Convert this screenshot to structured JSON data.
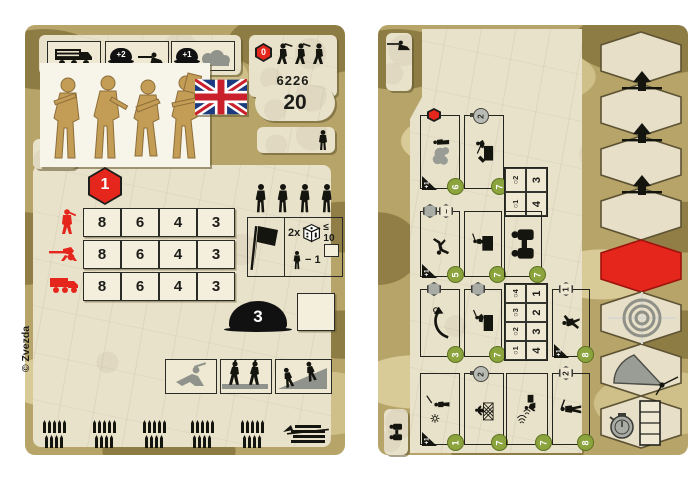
{
  "colors": {
    "accent_red": "#e5261d",
    "badge_green": "#8ba43e",
    "camo_base": "#b6a468",
    "camo_dark": "#8e7c45",
    "camo_light": "#d9cb97",
    "parchment": "#e9e2cb"
  },
  "left_card": {
    "catalog_number": "6226",
    "points": "20",
    "march_hex_value": "0",
    "alert_hex_value": "1",
    "transport_bonus": {
      "trench": "+2",
      "cover": "+1"
    },
    "stats": {
      "rows": [
        {
          "icon": "infantry",
          "values": [
            "8",
            "6",
            "4",
            "3"
          ]
        },
        {
          "icon": "machine-gun",
          "values": [
            "8",
            "6",
            "4",
            "3"
          ]
        },
        {
          "icon": "truck",
          "values": [
            "8",
            "6",
            "4",
            "3"
          ]
        }
      ]
    },
    "morale": {
      "dice_label": "2x",
      "threshold": "≤ 10",
      "penalty": "− 1"
    },
    "helmet_value": "3",
    "copyright": "© Zvezda"
  },
  "right_card": {
    "range_tables": [
      {
        "ranges": [
          "○1",
          "○2"
        ],
        "values": [
          "4",
          "3"
        ]
      },
      {
        "ranges": [
          "○1",
          "○2",
          "○3",
          "○4"
        ],
        "values": [
          "4",
          "3",
          "2",
          "1"
        ]
      }
    ],
    "rows": [
      {
        "boxes": [
          {
            "name": "smoke-screen",
            "marker": "red-hex",
            "badge": "6",
            "bonus": "+1"
          },
          {
            "name": "entrench-crate",
            "marker": "timer",
            "marker_value": "2",
            "badge": "7"
          }
        ]
      },
      {
        "boxes": [
          {
            "name": "casualty",
            "marker": "gray-hex-minus",
            "marker_value": "−",
            "badge": "5",
            "bonus": "+1"
          },
          {
            "name": "mount-crate",
            "badge": "7"
          },
          {
            "name": "observe",
            "badge": "7"
          }
        ]
      },
      {
        "boxes": [
          {
            "name": "turn-move",
            "marker": "gray-hex",
            "badge": "3"
          },
          {
            "name": "take-cover",
            "marker": "gray-hex",
            "badge": "7"
          },
          {
            "name": "assault-leap",
            "marker": "hex-number",
            "marker_value": "1",
            "badge": "8",
            "bonus": "+1"
          }
        ]
      },
      {
        "boxes": [
          {
            "name": "signal",
            "badge": "1",
            "bonus": "+1"
          },
          {
            "name": "climb-obstacle",
            "marker": "timer",
            "marker_value": "2",
            "badge": "7"
          },
          {
            "name": "radio-contact",
            "badge": "7"
          },
          {
            "name": "march",
            "marker": "hex-number",
            "marker_value": "2",
            "badge": "8"
          }
        ]
      }
    ]
  }
}
